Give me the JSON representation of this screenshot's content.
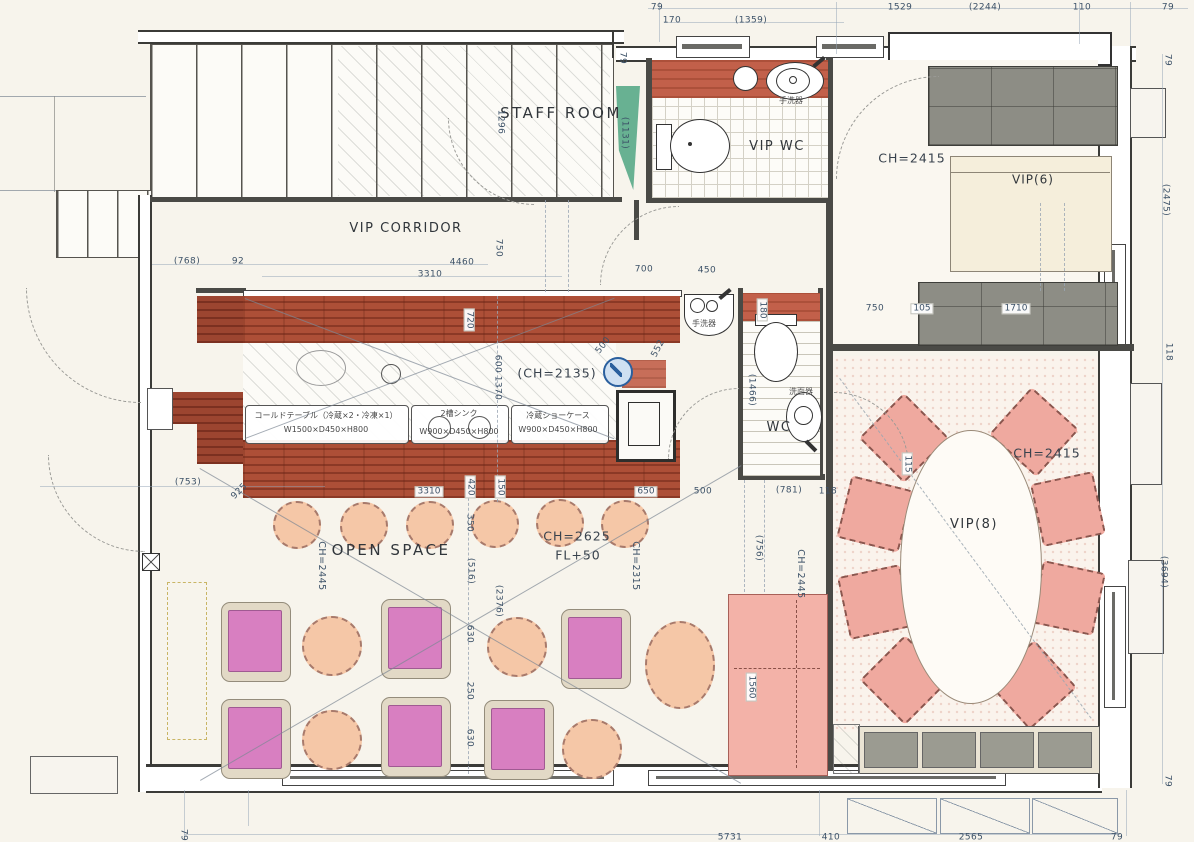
{
  "document": {
    "type": "architectural-floor-plan",
    "colors": {
      "paper": "#f7f4ec",
      "wall": "#4a4a46",
      "counter_wood": "#ad4f37",
      "vip_chair_pink": "#efa99f",
      "table_magenta": "#d87fc1",
      "round_table_peach": "#f5c7a7",
      "bench_gray": "#8d8d85",
      "accent_green": "#4fa582",
      "marker_blue": "#2a5f9e",
      "dimension_text": "#3d5268"
    }
  },
  "texts": [
    {
      "n": "staff-room-label",
      "t": "STAFF ROOM",
      "x": 561,
      "y": 114,
      "c": "room"
    },
    {
      "n": "vip-corridor-label",
      "t": "VIP CORRIDOR",
      "x": 406,
      "y": 229,
      "c": "room2"
    },
    {
      "n": "vip-wc-label",
      "t": "VIP WC",
      "x": 777,
      "y": 147,
      "c": "room2"
    },
    {
      "n": "vip6-label",
      "t": "VIP(6)",
      "x": 1033,
      "y": 180,
      "c": "room3"
    },
    {
      "n": "vip8-label",
      "t": "VIP(8)",
      "x": 974,
      "y": 525,
      "c": "room2"
    },
    {
      "n": "wc-label",
      "t": "WC",
      "x": 779,
      "y": 428,
      "c": "room2"
    },
    {
      "n": "open-space-label",
      "t": "OPEN SPACE",
      "x": 391,
      "y": 551,
      "c": "room"
    },
    {
      "n": "ceiling-height-vip6",
      "t": "CH=2415",
      "x": 912,
      "y": 158,
      "c": "ch"
    },
    {
      "n": "ceiling-height-vip8",
      "t": "CH=2415",
      "x": 1047,
      "y": 453,
      "c": "ch"
    },
    {
      "n": "ceiling-height-counter",
      "t": "(CH=2135)",
      "x": 557,
      "y": 373,
      "c": "ch"
    },
    {
      "n": "ceiling-height-open-space",
      "t": "CH=2625",
      "x": 577,
      "y": 536,
      "c": "ch"
    },
    {
      "n": "floor-level-open-space",
      "t": "FL+50",
      "x": 578,
      "y": 555,
      "c": "ch"
    },
    {
      "n": "ceiling-height-2445-left",
      "t": "CH=2445",
      "x": 321,
      "y": 566,
      "r": 90,
      "c": "chv"
    },
    {
      "n": "ceiling-height-2315",
      "t": "CH=2315",
      "x": 635,
      "y": 566,
      "r": 90,
      "c": "chv"
    },
    {
      "n": "ceiling-height-2445-right",
      "t": "CH=2445",
      "x": 800,
      "y": 574,
      "r": 90,
      "c": "chv"
    },
    {
      "n": "equipment-cold-table-name",
      "t": "コールドテーブル（冷蔵×2・冷凍×1）",
      "x": 326,
      "y": 416,
      "c": "eq"
    },
    {
      "n": "equipment-cold-table-size",
      "t": "W1500×D450×H800",
      "x": 326,
      "y": 430,
      "c": "eq"
    },
    {
      "n": "equipment-sink-name",
      "t": "2槽シンク",
      "x": 459,
      "y": 414,
      "c": "eq"
    },
    {
      "n": "equipment-sink-size",
      "t": "W900×D450×H800",
      "x": 459,
      "y": 432,
      "c": "eq"
    },
    {
      "n": "equipment-showcase-name",
      "t": "冷蔵ショーケース",
      "x": 558,
      "y": 416,
      "c": "eq"
    },
    {
      "n": "equipment-showcase-size",
      "t": "W900×D450×H800",
      "x": 558,
      "y": 430,
      "c": "eq"
    },
    {
      "n": "hand-basin-top-label",
      "t": "手洗器",
      "x": 791,
      "y": 101,
      "c": "jp"
    },
    {
      "n": "hand-basin-mid-label",
      "t": "手洗器",
      "x": 704,
      "y": 324,
      "c": "jp"
    },
    {
      "n": "wash-basin-label",
      "t": "洗面器",
      "x": 801,
      "y": 392,
      "c": "jp"
    },
    {
      "n": "dim-top-79-left",
      "t": "79",
      "x": 657,
      "y": 8,
      "c": "dim"
    },
    {
      "n": "dim-top-1529",
      "t": "1529",
      "x": 900,
      "y": 8,
      "c": "dim"
    },
    {
      "n": "dim-top-2244",
      "t": "(2244)",
      "x": 985,
      "y": 8,
      "c": "dim"
    },
    {
      "n": "dim-top-110",
      "t": "110",
      "x": 1082,
      "y": 8,
      "c": "dim"
    },
    {
      "n": "dim-top-79-right",
      "t": "79",
      "x": 1168,
      "y": 8,
      "c": "dim"
    },
    {
      "n": "dim-top-170",
      "t": "170",
      "x": 672,
      "y": 21,
      "c": "dim"
    },
    {
      "n": "dim-top-1359",
      "t": "(1359)",
      "x": 751,
      "y": 21,
      "c": "dim"
    },
    {
      "n": "dim-79-stair",
      "t": "79",
      "x": 622,
      "y": 58,
      "r": 90,
      "c": "dim"
    },
    {
      "n": "dim-1296",
      "t": "1296",
      "x": 500,
      "y": 122,
      "r": 90,
      "c": "dim"
    },
    {
      "n": "dim-1131",
      "t": "(1131)",
      "x": 624,
      "y": 133,
      "r": 90,
      "c": "dim"
    },
    {
      "n": "dim-right-79-top",
      "t": "79",
      "x": 1167,
      "y": 60,
      "r": 90,
      "c": "dim"
    },
    {
      "n": "dim-right-2475",
      "t": "(2475)",
      "x": 1165,
      "y": 200,
      "r": 90,
      "c": "dim"
    },
    {
      "n": "dim-corridor-768",
      "t": "(768)",
      "x": 187,
      "y": 262,
      "c": "dim"
    },
    {
      "n": "dim-corridor-92",
      "t": "92",
      "x": 238,
      "y": 262,
      "c": "dim"
    },
    {
      "n": "dim-corridor-4460",
      "t": "4460",
      "x": 462,
      "y": 263,
      "c": "dim"
    },
    {
      "n": "dim-corridor-3310",
      "t": "3310",
      "x": 430,
      "y": 275,
      "c": "dim"
    },
    {
      "n": "dim-corridor-750-v",
      "t": "750",
      "x": 498,
      "y": 248,
      "r": 90,
      "c": "dim"
    },
    {
      "n": "dim-700",
      "t": "700",
      "x": 644,
      "y": 270,
      "c": "dim"
    },
    {
      "n": "dim-450",
      "t": "450",
      "x": 707,
      "y": 271,
      "c": "dim"
    },
    {
      "n": "dim-750-vip6",
      "t": "750",
      "x": 875,
      "y": 309,
      "c": "dim"
    },
    {
      "n": "dim-105",
      "t": "105",
      "x": 922,
      "y": 309,
      "c": "dimbox"
    },
    {
      "n": "dim-1710",
      "t": "1710",
      "x": 1016,
      "y": 309,
      "c": "dimbox"
    },
    {
      "n": "dim-right-118",
      "t": "118",
      "x": 1168,
      "y": 352,
      "r": 90,
      "c": "dim"
    },
    {
      "n": "dim-720",
      "t": "720",
      "x": 469,
      "y": 320,
      "r": 90,
      "c": "dimbox"
    },
    {
      "n": "dim-600",
      "t": "600",
      "x": 497,
      "y": 364,
      "r": 90,
      "c": "dim"
    },
    {
      "n": "dim-1370",
      "t": "1370",
      "x": 497,
      "y": 388,
      "r": 90,
      "c": "dim"
    },
    {
      "n": "dim-500-leader",
      "t": "500",
      "x": 604,
      "y": 346,
      "r": -52,
      "c": "dim"
    },
    {
      "n": "dim-552-leader",
      "t": "552",
      "x": 659,
      "y": 349,
      "r": -62,
      "c": "dim"
    },
    {
      "n": "dim-180",
      "t": "180",
      "x": 762,
      "y": 310,
      "r": 90,
      "c": "dimbox"
    },
    {
      "n": "dim-1466",
      "t": "(1466)",
      "x": 751,
      "y": 390,
      "r": 90,
      "c": "dim"
    },
    {
      "n": "dim-counter-3310",
      "t": "3310",
      "x": 429,
      "y": 492,
      "c": "dimbox"
    },
    {
      "n": "dim-counter-420",
      "t": "420",
      "x": 470,
      "y": 487,
      "r": 90,
      "c": "dimbox"
    },
    {
      "n": "dim-counter-150",
      "t": "150",
      "x": 500,
      "y": 487,
      "r": 90,
      "c": "dimbox"
    },
    {
      "n": "dim-counter-650",
      "t": "650",
      "x": 646,
      "y": 492,
      "c": "dimbox"
    },
    {
      "n": "dim-500",
      "t": "500",
      "x": 703,
      "y": 492,
      "c": "dim"
    },
    {
      "n": "dim-781",
      "t": "(781)",
      "x": 789,
      "y": 491,
      "c": "dim"
    },
    {
      "n": "dim-118",
      "t": "118",
      "x": 828,
      "y": 492,
      "c": "dim"
    },
    {
      "n": "dim-925",
      "t": "925",
      "x": 240,
      "y": 492,
      "r": -45,
      "c": "dim"
    },
    {
      "n": "dim-753",
      "t": "(753)",
      "x": 188,
      "y": 483,
      "c": "dim"
    },
    {
      "n": "dim-350",
      "t": "350",
      "x": 469,
      "y": 523,
      "r": 90,
      "c": "dim"
    },
    {
      "n": "dim-516",
      "t": "(516)",
      "x": 470,
      "y": 571,
      "r": 90,
      "c": "dim"
    },
    {
      "n": "dim-2376",
      "t": "(2376)",
      "x": 498,
      "y": 601,
      "r": 90,
      "c": "dim"
    },
    {
      "n": "dim-630-a",
      "t": "630",
      "x": 469,
      "y": 634,
      "r": 90,
      "c": "dim"
    },
    {
      "n": "dim-250",
      "t": "250",
      "x": 469,
      "y": 691,
      "r": 90,
      "c": "dim"
    },
    {
      "n": "dim-630-b",
      "t": "630",
      "x": 469,
      "y": 738,
      "r": 90,
      "c": "dim"
    },
    {
      "n": "dim-756",
      "t": "(756)",
      "x": 758,
      "y": 548,
      "r": 90,
      "c": "dim"
    },
    {
      "n": "dim-1560",
      "t": "1560",
      "x": 751,
      "y": 687,
      "r": 90,
      "c": "dimbox"
    },
    {
      "n": "dim-vip8-115",
      "t": "115",
      "x": 907,
      "y": 464,
      "r": 90,
      "c": "dimbox"
    },
    {
      "n": "dim-right-3694",
      "t": "(3694)",
      "x": 1163,
      "y": 572,
      "r": 90,
      "c": "dim"
    },
    {
      "n": "dim-right-79-bottom",
      "t": "79",
      "x": 1167,
      "y": 781,
      "r": 90,
      "c": "dim"
    },
    {
      "n": "dim-bottom-79-left",
      "t": "79",
      "x": 183,
      "y": 835,
      "r": 90,
      "c": "dim"
    },
    {
      "n": "dim-bottom-5731",
      "t": "5731",
      "x": 730,
      "y": 838,
      "c": "dim"
    },
    {
      "n": "dim-bottom-410",
      "t": "410",
      "x": 831,
      "y": 838,
      "c": "dim"
    },
    {
      "n": "dim-bottom-2565",
      "t": "2565",
      "x": 971,
      "y": 838,
      "c": "dim"
    },
    {
      "n": "dim-bottom-79-right",
      "t": "79",
      "x": 1117,
      "y": 838,
      "c": "dim"
    }
  ]
}
